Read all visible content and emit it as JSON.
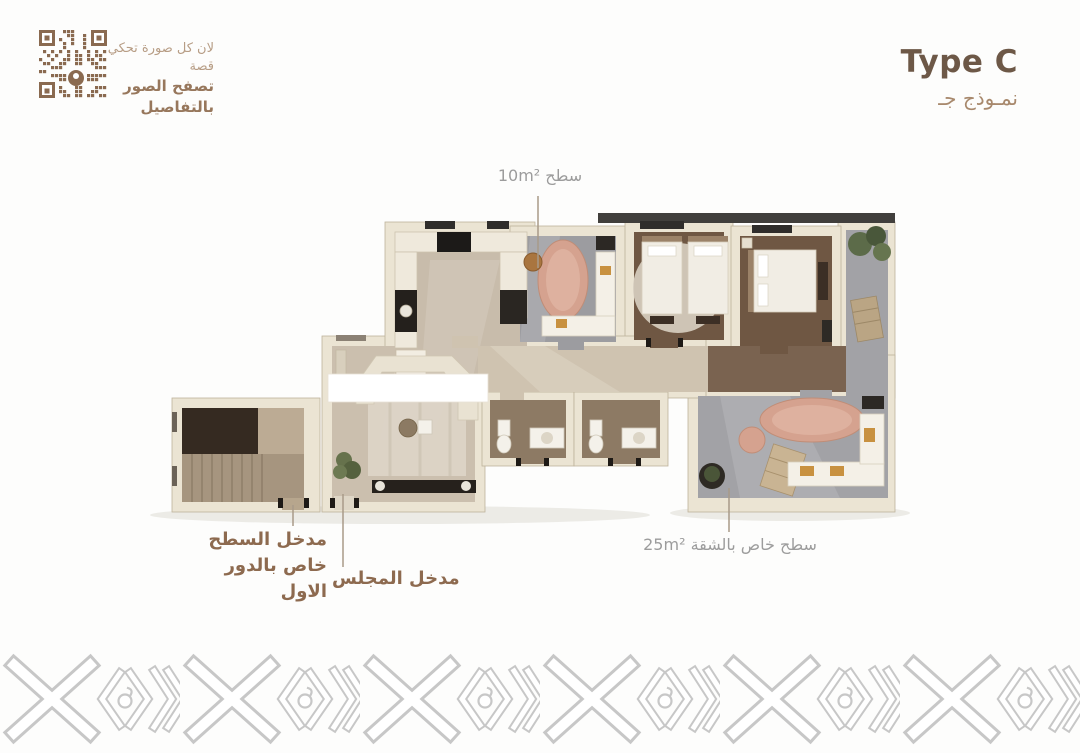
{
  "qr_block": {
    "tagline_line1": "لان كل صورة تحكي قصة",
    "tagline_line2": "تصفح الصور بالتفاصيل"
  },
  "header": {
    "title": "Type C",
    "subtitle_ar": "نمـوذج جـ"
  },
  "plan_labels": {
    "roof_terrace_10": "سطح 10m²",
    "apartment_terrace_25": "سطح خاص بالشقة 25m²",
    "roof_entrance_line1": "مدخل السطح",
    "roof_entrance_line2": "خاص بالدور الاول",
    "majlis_entrance": "مدخل المجلس"
  },
  "colors": {
    "accent_brown": "#8d6a4f",
    "title_brown": "#6d5847",
    "subtitle_tan": "#a8896d",
    "qr_brown": "#8a6a50",
    "muted_gray_label": "#9c9c9c",
    "wall_cream": "#ebe4d3",
    "floor_beige": "#cbbfae",
    "floor_brown": "#6f5743",
    "floor_gray": "#a0a0a4",
    "rug_salmon": "#d5a28f",
    "pattern_gray": "#c7c7c7"
  }
}
